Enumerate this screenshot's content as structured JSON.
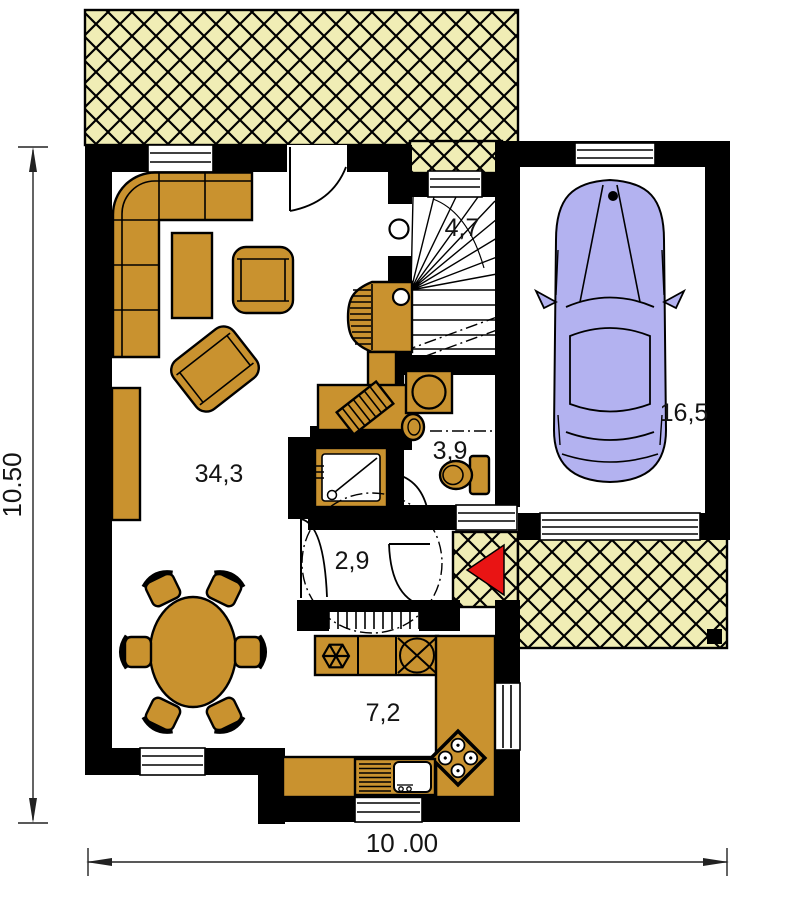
{
  "colors": {
    "wall": "#000000",
    "floor": "#ffffff",
    "furniture": "#c9922f",
    "hatch_bg": "#f0edb5",
    "car_body": "#b3b2f0",
    "entrance_arrow": "#e91414",
    "ink": "#141414"
  },
  "dimensions": {
    "height_label": "10.50",
    "width_label": "10 .00"
  },
  "rooms": {
    "living_room": {
      "area_label": "34,3"
    },
    "kitchen": {
      "area_label": "7,2"
    },
    "hallway": {
      "area_label": "2,9"
    },
    "bathroom": {
      "area_label": "3,9"
    },
    "staircase": {
      "area_label": "4,7"
    },
    "garage": {
      "area_label": "16,5"
    }
  },
  "symbols": {
    "entrance_arrow": "left-pointing-triangle",
    "freezer": "snowflake-in-hexagon",
    "sink_circle": "circle-with-cross",
    "cooktop": "diamond-four-burners",
    "kitchen_sink": "bowl-with-drainer",
    "shower": "square-with-diagonal-and-drain",
    "toilet": "bowl-with-cistern",
    "washing_machine": "square-with-drum",
    "tiled_stove": "ribbed-stove",
    "car": "car-top-view"
  }
}
